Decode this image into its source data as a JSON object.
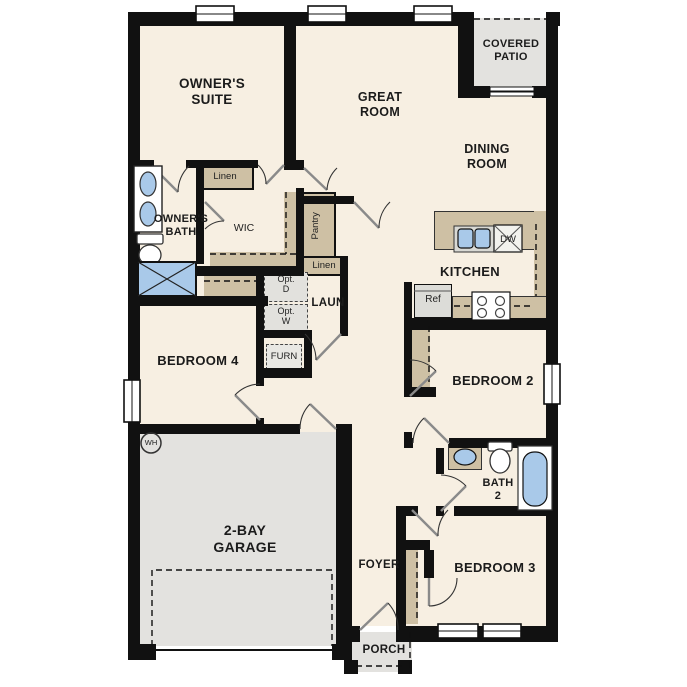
{
  "rooms": {
    "owners_suite": "OWNER'S\nSUITE",
    "great_room": "GREAT\nROOM",
    "covered_patio": "COVERED\nPATIO",
    "dining_room": "DINING\nROOM",
    "owners_bath": "OWNER'S\nBATH",
    "wic": "WIC",
    "pantry": "Pantry",
    "linen_upper": "Linen",
    "linen_lower": "Linen",
    "kitchen": "KITCHEN",
    "laundry": "LAUN",
    "bedroom_4": "BEDROOM 4",
    "bedroom_2": "BEDROOM 2",
    "bedroom_3": "BEDROOM 3",
    "bath_2": "BATH\n2",
    "garage": "2-BAY\nGARAGE",
    "foyer": "FOYER",
    "porch": "PORCH"
  },
  "appliances": {
    "opt_dryer": "Opt.\nD",
    "opt_washer": "Opt.\nW",
    "furnace": "FURN",
    "refrigerator": "Ref",
    "dishwasher": "DW",
    "water_heater": "WH"
  },
  "colors": {
    "wall": "#111111",
    "floor_cream": "#f7efe2",
    "floor_gray": "#e3e2df",
    "counter_tan": "#cec0a4",
    "fixture_blue": "#a9c9e9",
    "appliance_gray": "#e2e1dd"
  }
}
